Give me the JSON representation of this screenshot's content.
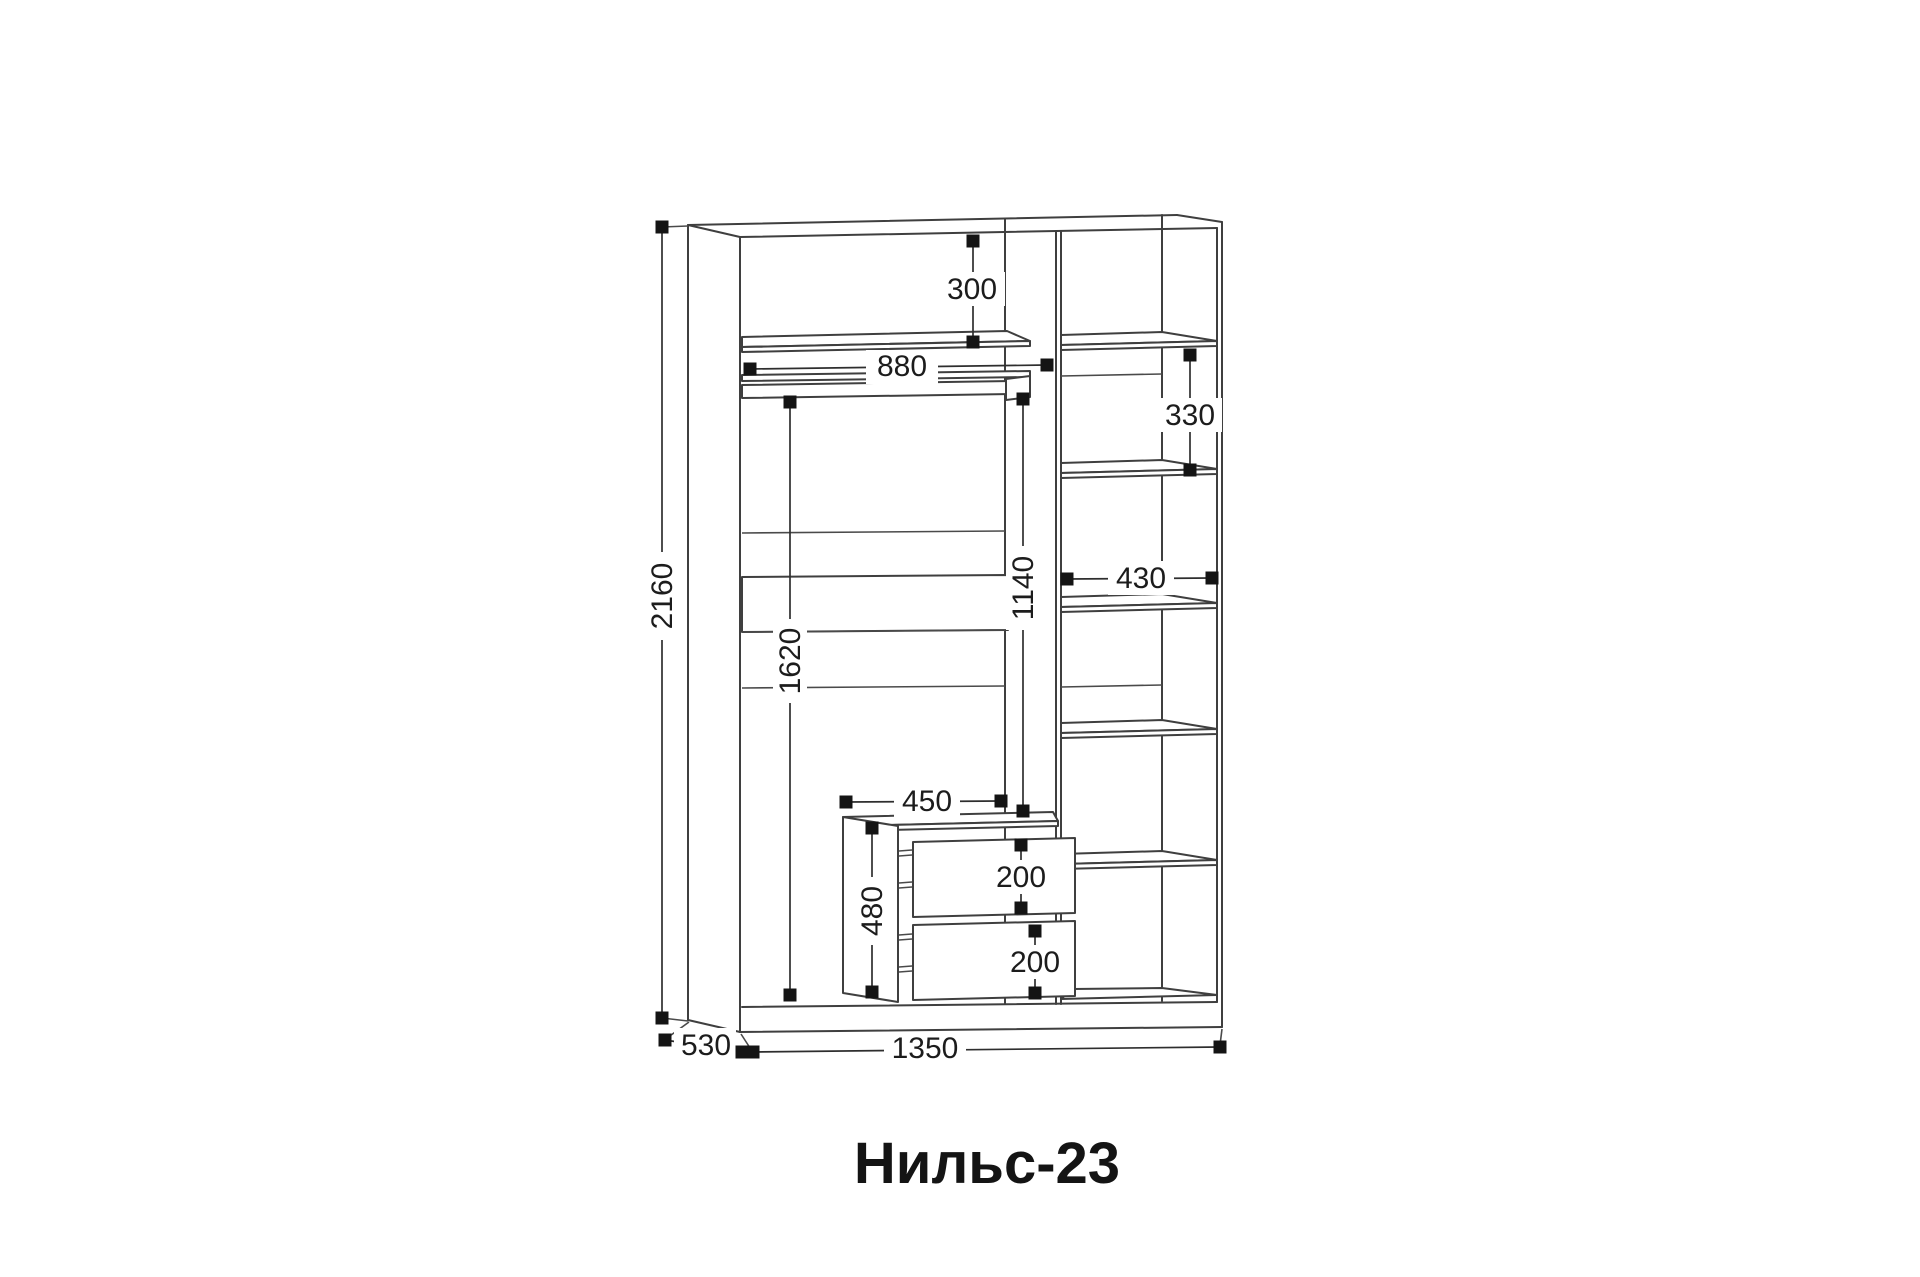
{
  "title": "Нильс-23",
  "dimensions": {
    "overall_height": "2160",
    "overall_width": "1350",
    "depth": "530",
    "top_section_height": "300",
    "left_section_width": "880",
    "right_shelf_spacing": "330",
    "right_column_width": "430",
    "rod_to_drawer_height": "1140",
    "hanging_zone_height": "1620",
    "drawer_unit_width": "450",
    "drawer_unit_height": "480",
    "drawer_top_height": "200",
    "drawer_bottom_height": "200"
  }
}
